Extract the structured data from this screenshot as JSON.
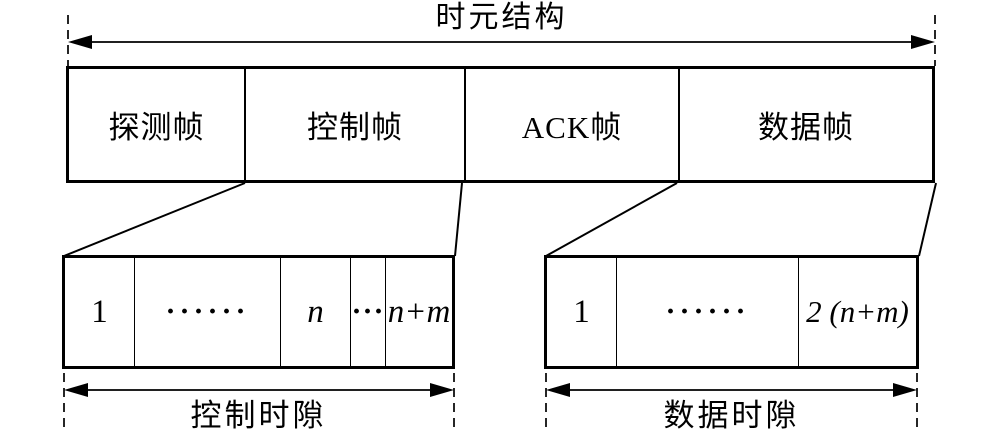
{
  "title": "时元结构",
  "colors": {
    "ink": "#000000",
    "background": "#ffffff"
  },
  "main_frame": {
    "cells": [
      {
        "label": "探测帧"
      },
      {
        "label": "控制帧"
      },
      {
        "label": "ACK帧"
      },
      {
        "label": "数据帧"
      }
    ]
  },
  "control_slots": {
    "cells": [
      "1",
      "······",
      "n",
      "···",
      "n+m"
    ],
    "caption": "控制时隙"
  },
  "data_slots": {
    "cells": [
      "1",
      "······",
      "2 (n+m)"
    ],
    "caption": "数据时隙"
  }
}
